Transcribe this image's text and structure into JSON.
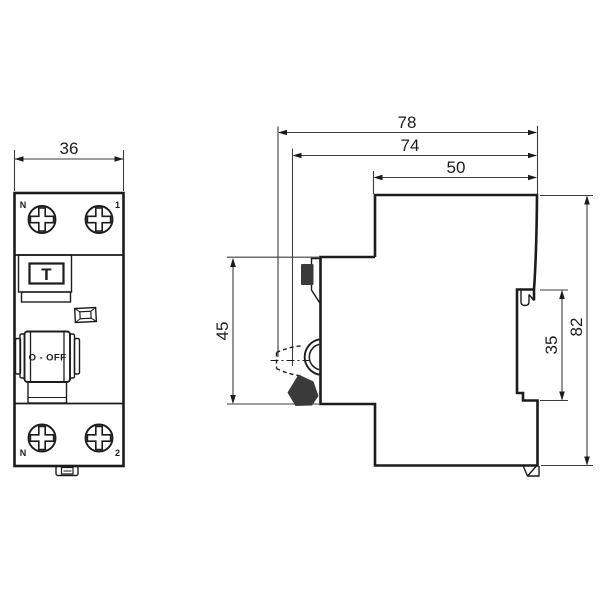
{
  "front_view": {
    "dim_width": "36",
    "label_top_left": "N",
    "label_top_right": "1",
    "label_bottom_left": "N",
    "label_bottom_right": "2",
    "test_button_label": "T",
    "switch_state_label": "O - OFF"
  },
  "side_view": {
    "dim_depth_overall": "78",
    "dim_depth_toggle": "74",
    "dim_depth_body": "50",
    "dim_front_section_height": "45",
    "dim_din_recess_height": "35",
    "dim_height_overall": "82"
  }
}
